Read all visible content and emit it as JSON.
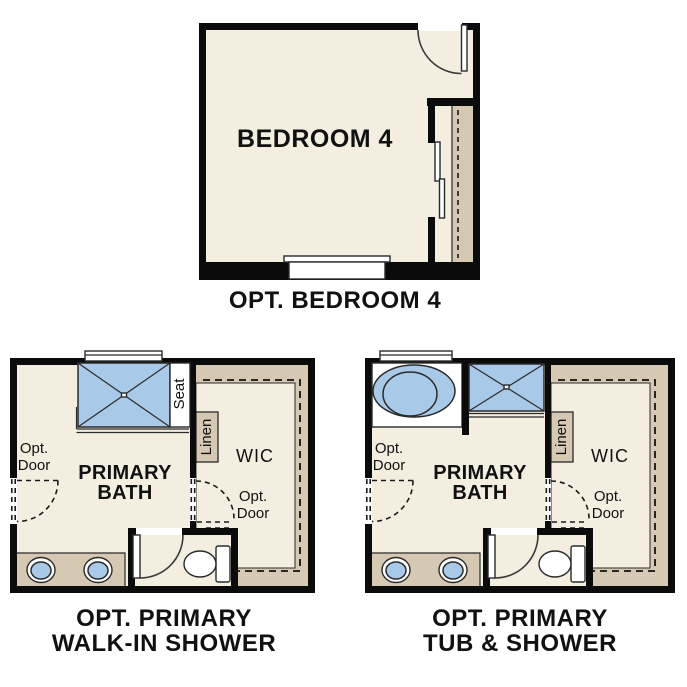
{
  "colors": {
    "wall": "#0b0b0b",
    "floor": "#f4eee1",
    "cabinet": "#d5c9b3",
    "fixture_blue": "#a9c9e8",
    "background": "#ffffff",
    "text": "#111111"
  },
  "plans": {
    "bedroom4": {
      "room_label": "BEDROOM 4",
      "caption": "OPT. BEDROOM 4"
    },
    "walk_in_shower": {
      "room_line1": "PRIMARY",
      "room_line2": "BATH",
      "seat": "Seat",
      "linen": "Linen",
      "wic": "WIC",
      "opt_door_line1": "Opt.",
      "opt_door_line2": "Door",
      "caption_line1": "OPT. PRIMARY",
      "caption_line2": "WALK-IN SHOWER"
    },
    "tub_shower": {
      "room_line1": "PRIMARY",
      "room_line2": "BATH",
      "linen": "Linen",
      "wic": "WIC",
      "opt_door_line1": "Opt.",
      "opt_door_line2": "Door",
      "caption_line1": "OPT. PRIMARY",
      "caption_line2": "TUB & SHOWER"
    }
  }
}
